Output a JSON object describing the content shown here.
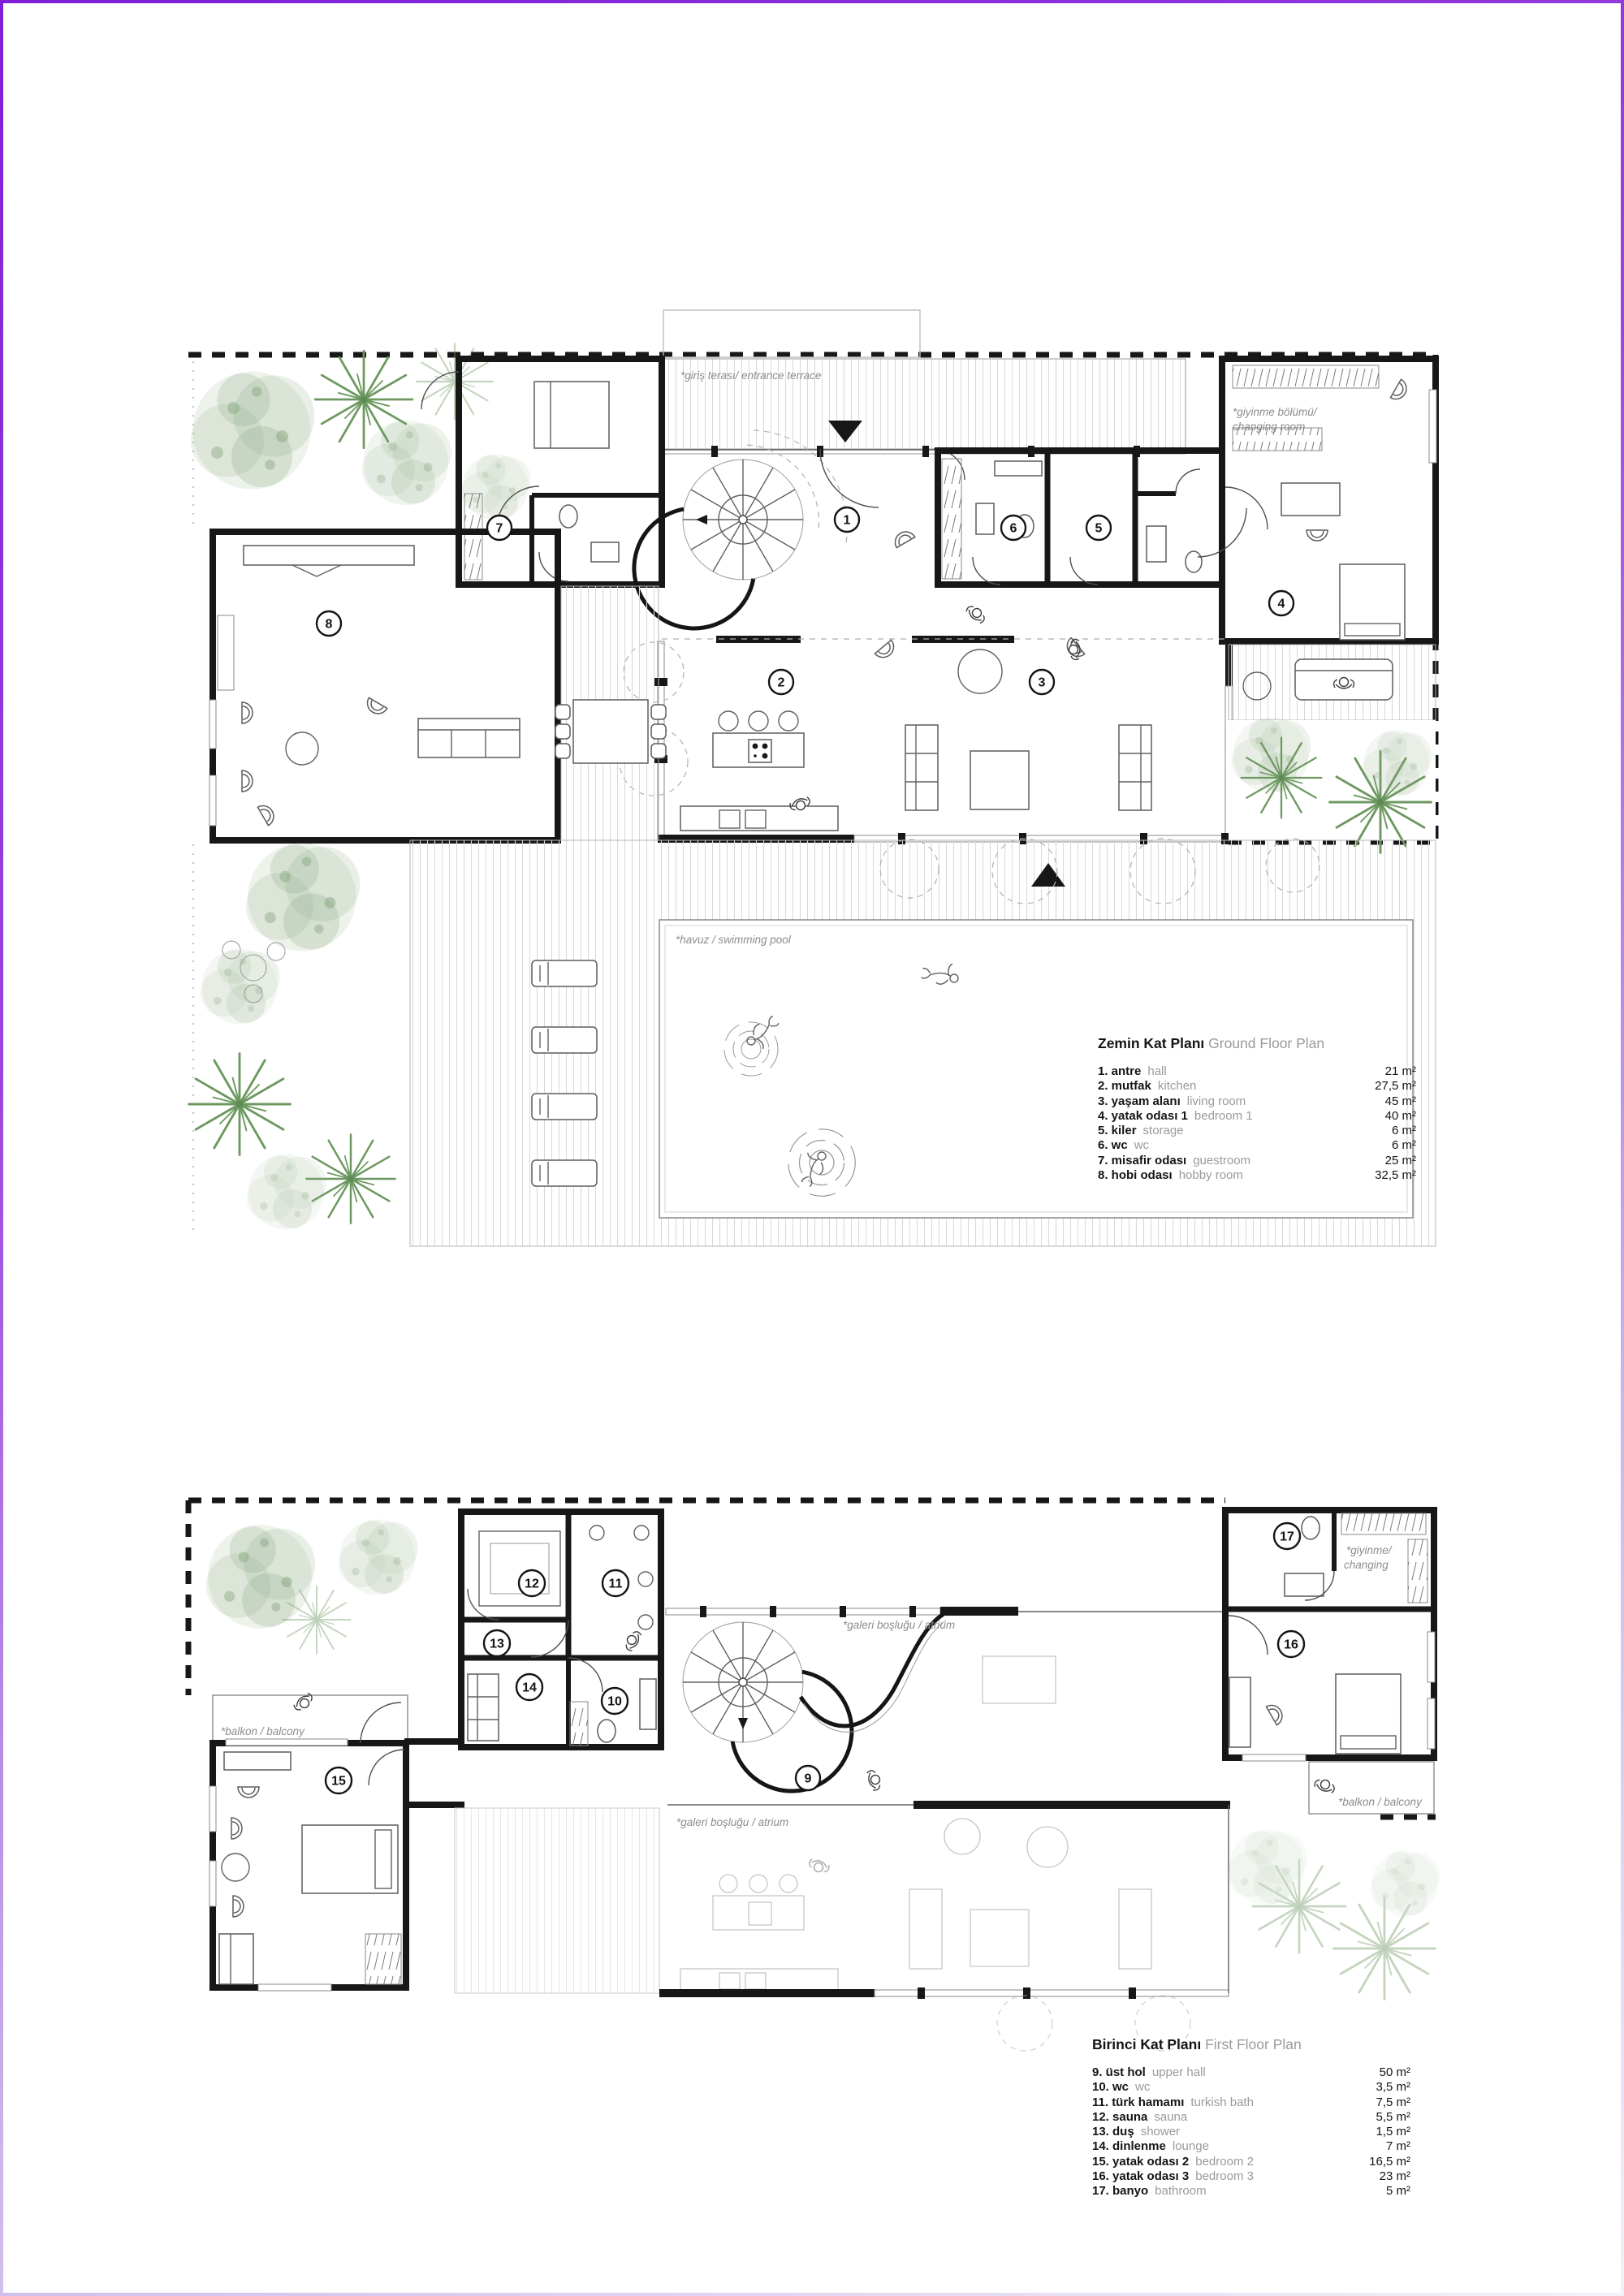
{
  "ground_floor": {
    "title_tr": "Zemin Kat Planı",
    "title_en": "Ground Floor Plan",
    "labels": {
      "entrance_terrace": "*giriş terası/ entrance terrace",
      "changing_line1": "*giyinme bölümü/",
      "changing_line2": "changing room",
      "pool": "*havuz / swimming pool"
    },
    "markers": [
      "1",
      "2",
      "3",
      "4",
      "5",
      "6",
      "7",
      "8"
    ],
    "legend": [
      {
        "name": "1. antre",
        "en": "hall",
        "area": "21 m²"
      },
      {
        "name": "2. mutfak",
        "en": "kitchen",
        "area": "27,5 m²"
      },
      {
        "name": "3. yaşam alanı",
        "en": "living room",
        "area": "45 m²"
      },
      {
        "name": "4. yatak odası 1",
        "en": "bedroom 1",
        "area": "40 m²"
      },
      {
        "name": "5. kiler",
        "en": "storage",
        "area": "6 m²"
      },
      {
        "name": "6. wc",
        "en": "wc",
        "area": "6 m²"
      },
      {
        "name": "7. misafir odası",
        "en": "guestroom",
        "area": "25 m²"
      },
      {
        "name": "8. hobi odası",
        "en": "hobby room",
        "area": "32,5 m²"
      }
    ]
  },
  "first_floor": {
    "title_tr": "Birinci Kat Planı",
    "title_en": "First Floor Plan",
    "labels": {
      "atrium_upper": "*galeri boşluğu / atrium",
      "atrium_lower": "*galeri boşluğu / atrium",
      "balcony_left": "*balkon / balcony",
      "balcony_right": "*balkon / balcony",
      "changing_line1": "*giyinme/",
      "changing_line2": "changing"
    },
    "markers": [
      "9",
      "10",
      "11",
      "12",
      "13",
      "14",
      "15",
      "16",
      "17"
    ],
    "legend": [
      {
        "name": "9. üst hol",
        "en": "upper hall",
        "area": "50 m²"
      },
      {
        "name": "10. wc",
        "en": "wc",
        "area": "3,5 m²"
      },
      {
        "name": "11. türk hamamı",
        "en": "turkish bath",
        "area": "7,5 m²"
      },
      {
        "name": "12. sauna",
        "en": "sauna",
        "area": "5,5 m²"
      },
      {
        "name": "13. duş",
        "en": "shower",
        "area": "1,5 m²"
      },
      {
        "name": "14. dinlenme",
        "en": "lounge",
        "area": "7 m²"
      },
      {
        "name": "15. yatak odası 2",
        "en": "bedroom 2",
        "area": "16,5 m²"
      },
      {
        "name": "16. yatak odası 3",
        "en": "bedroom 3",
        "area": "23 m²"
      },
      {
        "name": "17. banyo",
        "en": "bathroom",
        "area": "5 m²"
      }
    ]
  }
}
